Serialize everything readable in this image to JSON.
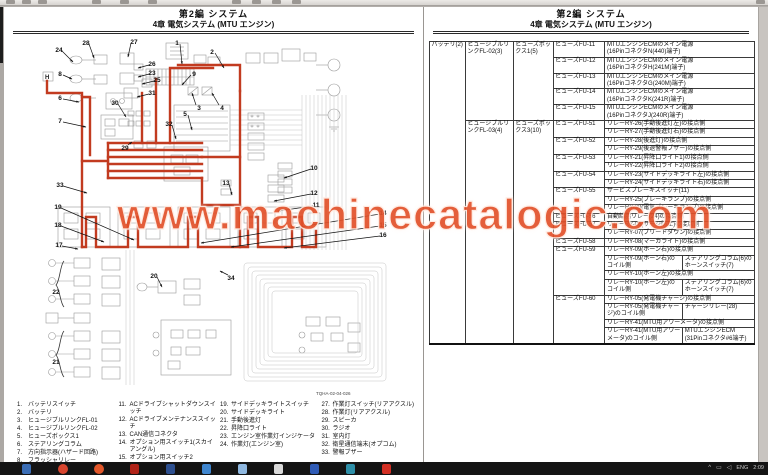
{
  "window": {
    "watermark": "www.machinecatalogic.com",
    "taskbar": {
      "icons": [
        {
          "name": "start-button",
          "color": "#3a6db5",
          "shape": "square"
        },
        {
          "name": "browser-chrome",
          "color": "#d8452e",
          "shape": "round"
        },
        {
          "name": "browser-opera",
          "color": "#e2572a",
          "shape": "round"
        },
        {
          "name": "pdf-reader",
          "color": "#b02318",
          "shape": "square"
        },
        {
          "name": "mail-app",
          "color": "#2d4f8f",
          "shape": "square"
        },
        {
          "name": "app-blue",
          "color": "#3f86cf",
          "shape": "square"
        },
        {
          "name": "file-explorer",
          "color": "#8fb8e0",
          "shape": "square"
        },
        {
          "name": "document-app",
          "color": "#d9d9d9",
          "shape": "square"
        },
        {
          "name": "word-app",
          "color": "#2f5bb5",
          "shape": "square"
        },
        {
          "name": "teal-app",
          "color": "#2e8fa8",
          "shape": "square"
        },
        {
          "name": "notification-badge",
          "color": "#d22f23",
          "shape": "square"
        }
      ],
      "tray": {
        "chevron": "^",
        "lang": "ENG",
        "time": "2:09"
      }
    }
  },
  "left_page": {
    "header": {
      "line1": "第2編 システム",
      "line2": "4章 電気システム (MTU エンジン)"
    },
    "figure_caption": "TQHA-02-04-026",
    "callouts": [
      {
        "n": "1",
        "x": 161,
        "y": 8,
        "tx": 166,
        "ty": 29
      },
      {
        "n": "2",
        "x": 196,
        "y": 17,
        "tx": 208,
        "ty": 33
      },
      {
        "n": "3",
        "x": 183,
        "y": 73,
        "tx": 176,
        "ty": 58
      },
      {
        "n": "4",
        "x": 206,
        "y": 73,
        "tx": 196,
        "ty": 58
      },
      {
        "n": "5",
        "x": 169,
        "y": 79,
        "tx": 176,
        "ty": 95
      },
      {
        "n": "6",
        "x": 44,
        "y": 63,
        "tx": 63,
        "ty": 67
      },
      {
        "n": "7",
        "x": 44,
        "y": 86,
        "tx": 70,
        "ty": 92
      },
      {
        "n": "8",
        "x": 44,
        "y": 39,
        "tx": 56,
        "ty": 44
      },
      {
        "n": "9",
        "x": 178,
        "y": 39,
        "tx": 166,
        "ty": 50
      },
      {
        "n": "10",
        "x": 298,
        "y": 133,
        "tx": 268,
        "ty": 143
      },
      {
        "n": "11",
        "x": 300,
        "y": 170,
        "tx": 262,
        "ty": 176
      },
      {
        "n": "12",
        "x": 298,
        "y": 158,
        "tx": 258,
        "ty": 166
      },
      {
        "n": "13",
        "x": 210,
        "y": 148,
        "tx": 216,
        "ty": 160
      },
      {
        "n": "14",
        "x": 367,
        "y": 178,
        "tx": 185,
        "ty": 208
      },
      {
        "n": "15",
        "x": 367,
        "y": 190,
        "tx": 215,
        "ty": 212
      },
      {
        "n": "16",
        "x": 367,
        "y": 200,
        "tx": 268,
        "ty": 213
      },
      {
        "n": "17",
        "x": 43,
        "y": 210,
        "tx": 62,
        "ty": 214
      },
      {
        "n": "18",
        "x": 42,
        "y": 190,
        "tx": 88,
        "ty": 207
      },
      {
        "n": "19",
        "x": 42,
        "y": 172,
        "tx": 118,
        "ty": 205
      },
      {
        "n": "20",
        "x": 138,
        "y": 241,
        "tx": 146,
        "ty": 252
      },
      {
        "n": "21",
        "x": 40,
        "y": 327
      },
      {
        "n": "22",
        "x": 40,
        "y": 257
      },
      {
        "n": "23",
        "x": 136,
        "y": 38,
        "tx": 122,
        "ty": 42
      },
      {
        "n": "24",
        "x": 43,
        "y": 15,
        "tx": 57,
        "ty": 27
      },
      {
        "n": "25",
        "x": 141,
        "y": 45,
        "tx": 126,
        "ty": 49
      },
      {
        "n": "26",
        "x": 136,
        "y": 29,
        "tx": 122,
        "ty": 33
      },
      {
        "n": "27",
        "x": 118,
        "y": 7,
        "tx": 112,
        "ty": 22
      },
      {
        "n": "28",
        "x": 70,
        "y": 8,
        "tx": 78,
        "ty": 23
      },
      {
        "n": "29",
        "x": 109,
        "y": 113,
        "tx": 116,
        "ty": 107
      },
      {
        "n": "30",
        "x": 99,
        "y": 68,
        "tx": 110,
        "ty": 82
      },
      {
        "n": "31",
        "x": 136,
        "y": 58,
        "tx": 121,
        "ty": 62
      },
      {
        "n": "32",
        "x": 153,
        "y": 89,
        "tx": 160,
        "ty": 104
      },
      {
        "n": "33",
        "x": 44,
        "y": 150,
        "tx": 71,
        "ty": 158
      },
      {
        "n": "34",
        "x": 215,
        "y": 243,
        "tx": 204,
        "ty": 236
      }
    ],
    "legend": [
      [
        {
          "n": "1.",
          "t": "バッテリスイッチ"
        },
        {
          "n": "2.",
          "t": "バッテリ"
        },
        {
          "n": "3.",
          "t": "ヒュージブルリンクFL-01"
        },
        {
          "n": "4.",
          "t": "ヒュージブルリンクFL-02"
        },
        {
          "n": "5.",
          "t": "ヒューズボックス1"
        },
        {
          "n": "6.",
          "t": "ステアリングコラム"
        },
        {
          "n": "7.",
          "t": "方向指示器(ハザード回路)"
        },
        {
          "n": "8.",
          "t": "フラッシャリレー"
        }
      ],
      [
        {
          "n": "11.",
          "t": "ACドライブシャットダウンスイッチ"
        },
        {
          "n": "12.",
          "t": "ACドライブメンテナンススイッチ"
        },
        {
          "n": "13.",
          "t": "CAN通信コネクタ"
        },
        {
          "n": "14.",
          "t": "オプション用スイッチ1(スカイアングル)"
        },
        {
          "n": "15.",
          "t": "オプション用スイッチ2"
        }
      ],
      [
        {
          "n": "19.",
          "t": "サイドデッキライトスイッチ"
        },
        {
          "n": "20.",
          "t": "サイドデッキライト"
        },
        {
          "n": "21.",
          "t": "手動後進灯"
        },
        {
          "n": "22.",
          "t": "昇降口ライト"
        },
        {
          "n": "23.",
          "t": "エンジン室作業灯インジケータ"
        },
        {
          "n": "24.",
          "t": "作業灯(エンジン室)"
        }
      ],
      [
        {
          "n": "27.",
          "t": "作業灯スイッチ(リアアクスル)"
        },
        {
          "n": "28.",
          "t": "作業灯(リアアクスル)"
        },
        {
          "n": "29.",
          "t": "スピーカ"
        },
        {
          "n": "30.",
          "t": "ラジオ"
        },
        {
          "n": "31.",
          "t": "室内灯"
        },
        {
          "n": "32.",
          "t": "衛星通信端末(オプコム)"
        },
        {
          "n": "33.",
          "t": "警報ブザー"
        }
      ]
    ]
  },
  "right_page": {
    "header": {
      "line1": "第2編 システム",
      "line2": "4章 電気システム (MTU エンジン)"
    },
    "table": {
      "rows": [
        {
          "cells": [
            {
              "t": "バッテリ(2)",
              "rs": 28
            },
            {
              "t": "ヒュージブルリンクFL-02(3)",
              "rs": 5
            },
            {
              "t": "ヒューズボックス1(5)",
              "rs": 5
            },
            {
              "t": "ヒューズFU-11"
            },
            {
              "t": "MTUエンジンECMのメイン電源\n(16PinコネクタN(440)端子)",
              "cs": 2
            }
          ]
        },
        {
          "cells": [
            {
              "t": "ヒューズFU-12"
            },
            {
              "t": "MTUエンジンECMのメイン電源\n(16PinコネクタH(241M)端子)",
              "cs": 2
            }
          ]
        },
        {
          "cells": [
            {
              "t": "ヒューズFU-13"
            },
            {
              "t": "MTUエンジンECMのメイン電源\n(16PinコネクタG(240M)端子)",
              "cs": 2
            }
          ]
        },
        {
          "cells": [
            {
              "t": "ヒューズFU-14"
            },
            {
              "t": "MTUエンジンECMのメイン電源\n(16PinコネクタK(241R)端子)",
              "cs": 2
            }
          ]
        },
        {
          "cells": [
            {
              "t": "ヒューズFU-15"
            },
            {
              "t": "MTUエンジンECMのメイン電源\n(16PinコネクタJ(240R)端子)",
              "cs": 2
            }
          ]
        },
        {
          "cells": [
            {
              "t": "ヒュージブルリンクFL-03(4)",
              "rs": 23
            },
            {
              "t": "ヒューズボックス3(10)",
              "rs": 23
            },
            {
              "t": "ヒューズFU-51",
              "rs": 2
            },
            {
              "t": "リレーRY-26(手動後進灯左)の接点側",
              "cs": 2
            }
          ]
        },
        {
          "cells": [
            {
              "t": "リレーRY-27(手動後進灯右)の接点側",
              "cs": 2
            }
          ]
        },
        {
          "cells": [
            {
              "t": "ヒューズFU-52",
              "rs": 2
            },
            {
              "t": "リレーRY-28(後進灯)の接点側",
              "cs": 2
            }
          ]
        },
        {
          "cells": [
            {
              "t": "リレーRY-29(後退警報ブザー)の接点側",
              "cs": 2
            }
          ]
        },
        {
          "cells": [
            {
              "t": "ヒューズFU-53",
              "rs": 2
            },
            {
              "t": "リレーRY-21(昇降口ライト1)の接点側",
              "cs": 2
            }
          ]
        },
        {
          "cells": [
            {
              "t": "リレーRY-22(昇降口ライト2)の接点側",
              "cs": 2
            }
          ]
        },
        {
          "cells": [
            {
              "t": "ヒューズFU-54",
              "rs": 2
            },
            {
              "t": "リレーRY-23(サイドデッキライト左)の接点側",
              "cs": 2
            }
          ]
        },
        {
          "cells": [
            {
              "t": "リレーRY-24(サイドデッキライト右)の接点側",
              "cs": 2
            }
          ]
        },
        {
          "cells": [
            {
              "t": "ヒューズFU-55",
              "rs": 3
            },
            {
              "t": "サービスブレーキスイッチ(11)",
              "cs": 2
            }
          ]
        },
        {
          "cells": [
            {
              "t": "リレーRY-25(ブレーキランプ)の接点側",
              "cs": 2
            }
          ]
        },
        {
          "cells": [
            {
              "t": "リレーRY-30(電気ブレーキランプ)の接点側",
              "cs": 2
            }
          ]
        },
        {
          "cells": [
            {
              "t": "ヒューズFU-56"
            },
            {
              "t": "自動給脂リレー(24)の接点側",
              "cs": 2
            }
          ]
        },
        {
          "cells": [
            {
              "t": "ヒューズFU-57",
              "rs": 2
            },
            {
              "t": "リレーRY-06(サージ防止)の接点側",
              "cs": 2
            }
          ]
        },
        {
          "cells": [
            {
              "t": "リレーRY-07(ブリードダウン)の接点側",
              "cs": 2
            }
          ]
        },
        {
          "cells": [
            {
              "t": "ヒューズFU-58"
            },
            {
              "t": "リレーRY-08(マーカライト)の接点側",
              "cs": 2
            }
          ]
        },
        {
          "cells": [
            {
              "t": "ヒューズFU-59",
              "rs": 4
            },
            {
              "t": "リレーRY-09(ホーン右)の接点側",
              "cs": 2
            }
          ]
        },
        {
          "cells": [
            {
              "t": "リレーRY-09(ホーン右)のコイル側"
            },
            {
              "t": "ステアリングコラム(6)のホーンスイッチ(7)"
            }
          ]
        },
        {
          "cells": [
            {
              "t": "リレーRY-10(ホーン左)の接点側",
              "cs": 2
            }
          ]
        },
        {
          "cells": [
            {
              "t": "リレーRY-10(ホーン左)のコイル側"
            },
            {
              "t": "ステアリングコラム(6)のホーンスイッチ(7)"
            }
          ]
        },
        {
          "cells": [
            {
              "t": "ヒューズFU-60",
              "rs": 4
            },
            {
              "t": "リレーRY-05(発電機チャージ)の接点側",
              "cs": 2
            }
          ]
        },
        {
          "cells": [
            {
              "t": "リレーRY-05(発電機チャージ)のコイル側"
            },
            {
              "t": "チャージリレー(28)"
            }
          ]
        },
        {
          "cells": [
            {
              "t": "リレーRY-41(MTU用アワーメータ)の接点側",
              "cs": 2
            }
          ]
        },
        {
          "cells": [
            {
              "t": "リレーRY-41(MTU用アワーメータ)のコイル側"
            },
            {
              "t": "MTUエンジンECM\n(31Pinコネクタ#6端子)"
            }
          ]
        }
      ]
    }
  }
}
